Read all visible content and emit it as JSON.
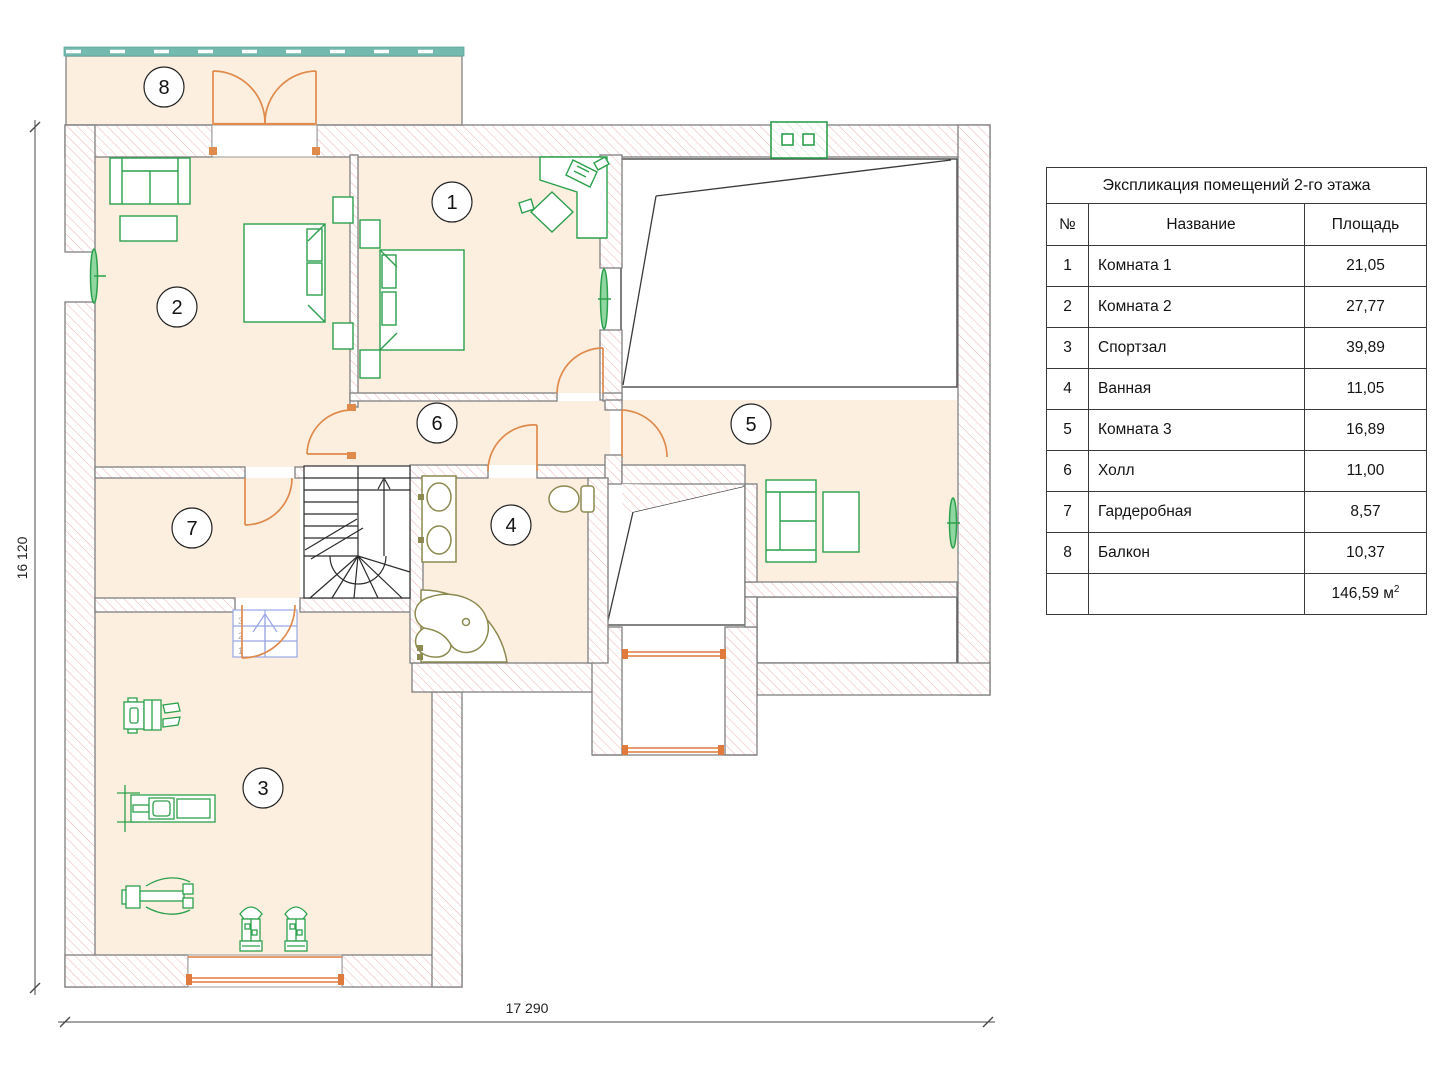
{
  "plan": {
    "room_labels": [
      "1",
      "2",
      "3",
      "4",
      "5",
      "6",
      "7",
      "8"
    ],
    "stair_steps": [
      "1",
      "2",
      "3"
    ],
    "dimensions": {
      "bottom": "17 290",
      "left": "16 120"
    }
  },
  "legend_table": {
    "title": "Экспликация помещений 2-го этажа",
    "columns": {
      "num": "№",
      "name": "Название",
      "area": "Площадь"
    },
    "rows": [
      {
        "num": "1",
        "name": "Комната 1",
        "area": "21,05"
      },
      {
        "num": "2",
        "name": "Комната 2",
        "area": "27,77"
      },
      {
        "num": "3",
        "name": "Спортзал",
        "area": "39,89"
      },
      {
        "num": "4",
        "name": "Ванная",
        "area": "11,05"
      },
      {
        "num": "5",
        "name": "Комната 3",
        "area": "16,89"
      },
      {
        "num": "6",
        "name": "Холл",
        "area": "11,00"
      },
      {
        "num": "7",
        "name": "Гардеробная",
        "area": "8,57"
      },
      {
        "num": "8",
        "name": "Балкон",
        "area": "10,37"
      }
    ],
    "total": {
      "value": "146,59 м",
      "sup": "2"
    }
  },
  "colors": {
    "floor": "#fcefe0",
    "wall_hatch": "#eeb3b3",
    "wall_edge": "#7f7f7f",
    "furniture_green": "#2ca04c",
    "door_orange": "#e08a4c",
    "fixture_olive": "#8c8a50",
    "balcony_rail_teal": "#74b9ae",
    "mini_stair_blue": "#98a6e4",
    "outline_dark": "#3a3a3a"
  }
}
